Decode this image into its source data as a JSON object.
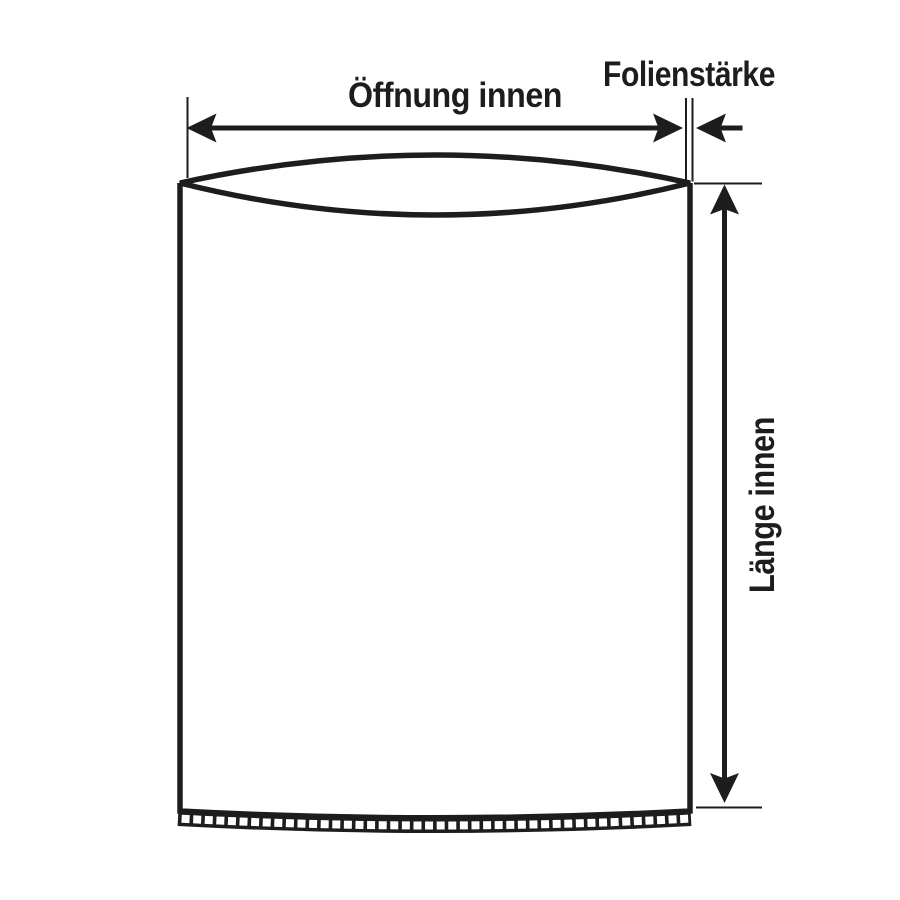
{
  "labels": {
    "opening": "Öffnung innen",
    "film_thickness": "Folienstärke",
    "length": "Länge innen"
  },
  "colors": {
    "ink": "#1d1d1b",
    "background": "#ffffff"
  }
}
